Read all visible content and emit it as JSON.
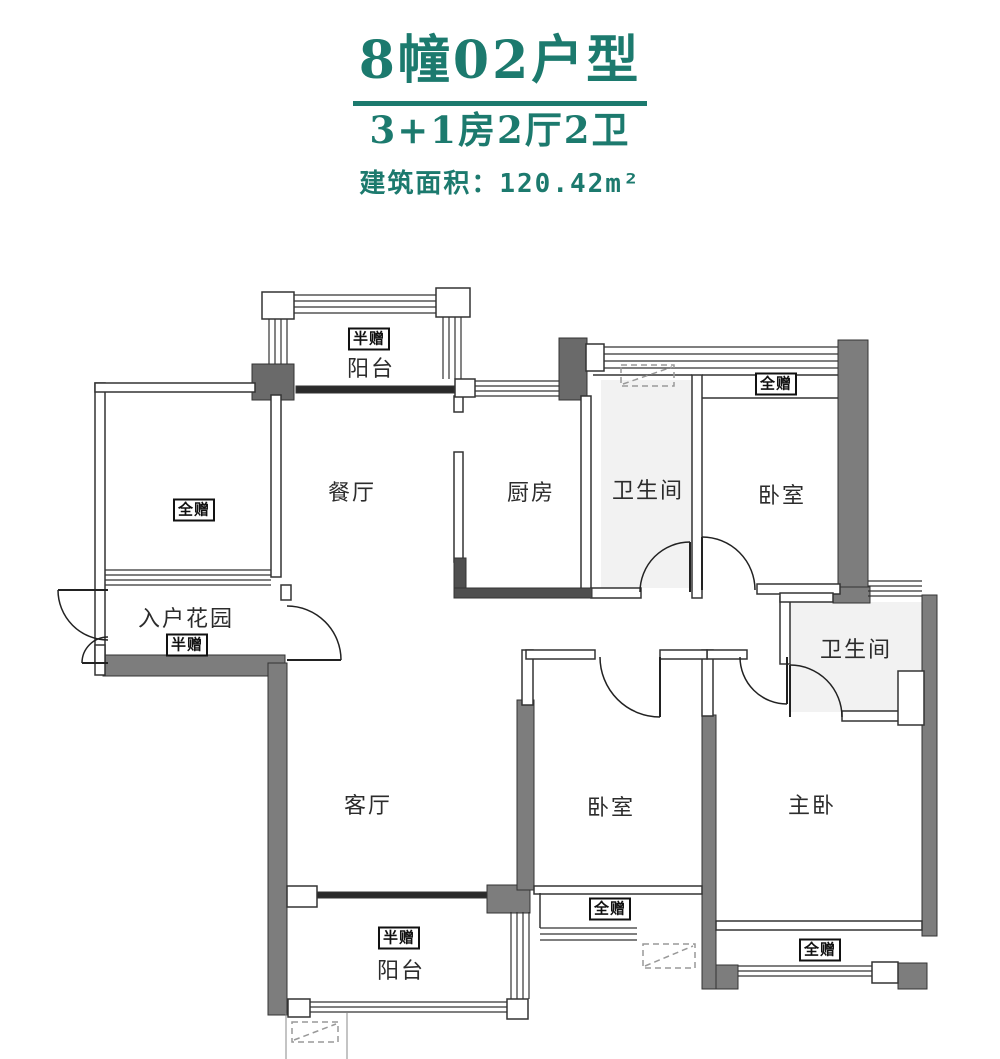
{
  "header": {
    "title": "8幢02户型",
    "subtitle": "3+1房2厅2卫",
    "area": "建筑面积：120.42m²"
  },
  "colors": {
    "accent": "#1c7a6e",
    "wall": "#333333",
    "wall_fill": "#7d7d7d"
  },
  "rooms": {
    "balcony_top": {
      "name": "阳台",
      "tag": "半赠"
    },
    "gift_room": {
      "tag": "全赠"
    },
    "dining": {
      "name": "餐厅"
    },
    "kitchen": {
      "name": "厨房"
    },
    "bath_top": {
      "name": "卫生间"
    },
    "bedroom_top": {
      "name": "卧室",
      "tag": "全赠"
    },
    "entry_garden": {
      "name": "入户花园",
      "tag": "半赠"
    },
    "bath_mid": {
      "name": "卫生间"
    },
    "living": {
      "name": "客厅"
    },
    "bedroom_mid": {
      "name": "卧室",
      "tag": "全赠"
    },
    "master": {
      "name": "主卧",
      "tag": "全赠"
    },
    "balcony_bottom": {
      "name": "阳台",
      "tag": "半赠"
    }
  }
}
